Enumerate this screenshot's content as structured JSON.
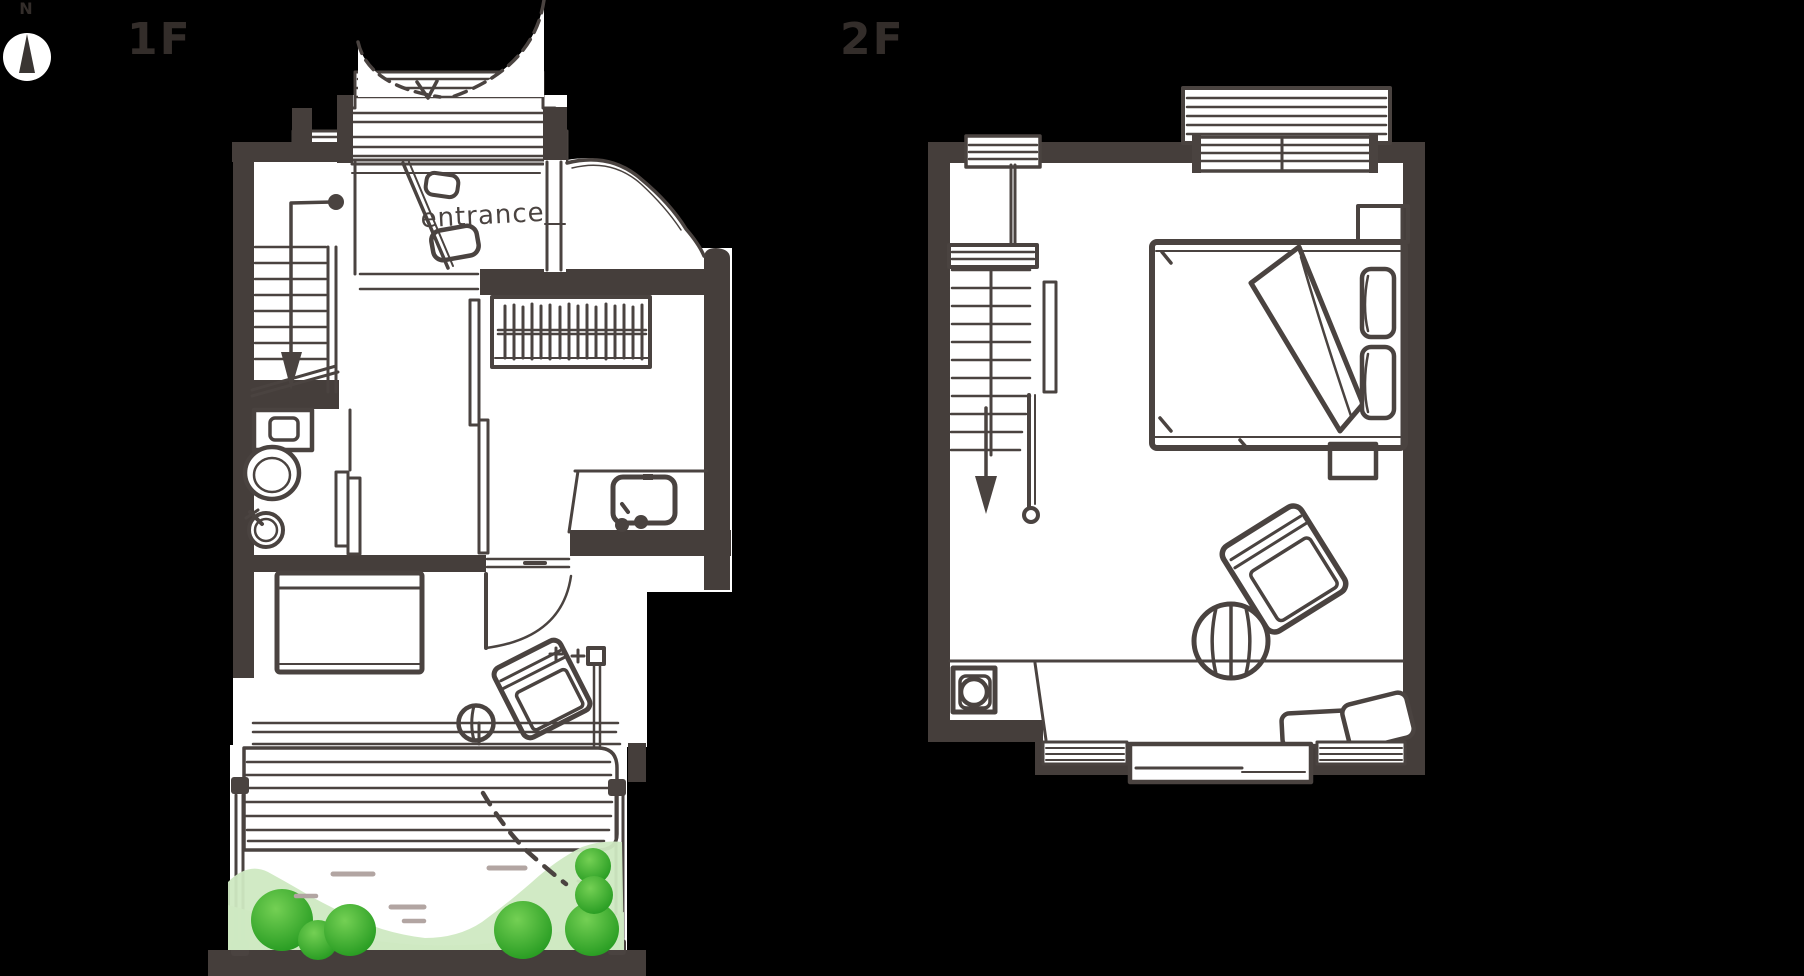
{
  "canvas": {
    "width": 1804,
    "height": 976,
    "background": "#000000"
  },
  "colors": {
    "bg": "#000000",
    "ink": "#4a4340",
    "wall": "#453e3b",
    "paper": "#ffffff",
    "label": "#332d2a",
    "bush_dark": "#23991f",
    "bush_light": "#74d054",
    "ground": "#cfe9c2",
    "pebble": "#b2a5a2"
  },
  "compass": {
    "north_label": "N"
  },
  "floors": {
    "floor1": {
      "label": "1F",
      "entrance_label": "entrance"
    },
    "floor2": {
      "label": "2F"
    }
  }
}
